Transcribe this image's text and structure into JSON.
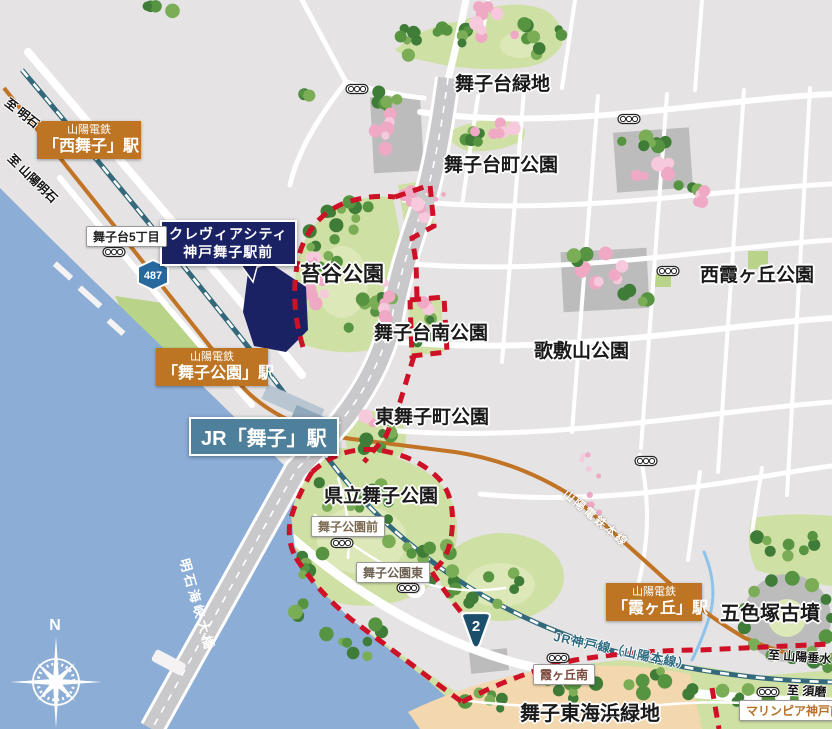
{
  "parks": {
    "maikodai_ryokuchi": "舞子台緑地",
    "maikodaicho_koen": "舞子台町公園",
    "nishi_kasumigaoka_koen": "西霞ヶ丘公園",
    "kokedani_koen": "苔谷公園",
    "maikodai_minami_koen": "舞子台南公園",
    "utashikiyama_koen": "歌敷山公園",
    "higashi_maikocho_koen": "東舞子町公園",
    "kenritsu_maiko_koen": "県立舞子公園",
    "goshikizuka_kofun": "五色塚古墳",
    "maiko_higashi_kaihin_ryokuchi": "舞子東海浜緑地"
  },
  "stations": {
    "nishi_maiko": {
      "line": "山陽電鉄",
      "name": "「西舞子」駅"
    },
    "maiko_koen": {
      "line": "山陽電鉄",
      "name": "「舞子公園」駅"
    },
    "kasumigaoka": {
      "line": "山陽電鉄",
      "name": "「霞ヶ丘」駅"
    },
    "jr_maiko": {
      "name": "JR「舞子」駅"
    }
  },
  "property": {
    "line1": "クレヴィアシティ",
    "line2": "神戸舞子駅前"
  },
  "spots": {
    "maikodai_5chome": "舞子台5丁目",
    "maiko_koen_mae": "舞子公園前",
    "maiko_koen_higashi": "舞子公園東",
    "kasumigaoka_minami": "霞ヶ丘南",
    "marinpia_kobe_mae": "マリンピア神戸前"
  },
  "rail_lines": {
    "sanyo_honsen": "山陽電鉄本線",
    "jr_kobe_line": "JR神戸線（山陽本線）"
  },
  "directions": {
    "to_akashi": "至 明石",
    "to_sanyo_akashi": "至 山陽明石",
    "to_sanyo_tarumi": "至 山陽垂水",
    "to_suma": "至 須磨"
  },
  "bridge": {
    "name": "明石海峡大橋"
  },
  "routes": {
    "r487": "487",
    "r2": "2"
  },
  "compass": {
    "north": "N"
  },
  "colors": {
    "sea": "#8badd6",
    "land": "#e5e3e4",
    "park": "#cfe0a4",
    "lawn": "#dde8b8",
    "beach": "#f3d7ae",
    "road": "#ffffff",
    "expressway": "#c9c8ca",
    "rail_sanyo": "#c17425",
    "rail_jr": "#33697b",
    "boundary_red": "#ce1126",
    "navy": "#1b2264",
    "station_orange": "#bd7524",
    "station_jr_bg": "#4e7f9b",
    "gray_block": "#bdbcbd",
    "tree_dark": "#3e7c38",
    "tree_mid": "#579441",
    "tree_light": "#7aad55",
    "blossom": "#efa9c5",
    "blossom_light": "#f6c9dc",
    "stream": "#8ec3ea"
  }
}
